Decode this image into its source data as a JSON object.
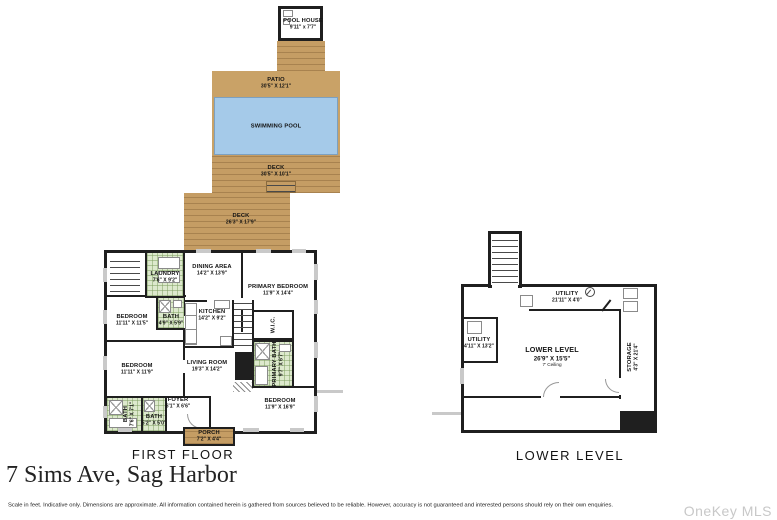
{
  "title": "7 Sims Ave, Sag Harbor",
  "disclaimer": "Scale in feet. Indicative only. Dimensions are approximate. All information contained herein is gathered from sources believed to be reliable. However, accuracy is not guaranteed and interested persons should rely on their own enquiries.",
  "watermark": "OneKey MLS",
  "colors": {
    "deck": "#c59d64",
    "patio": "#c9a267",
    "pool": "#a5cae9",
    "tile": "#dde9cd",
    "wall": "#1f1f1f"
  },
  "first_floor": {
    "caption": "FIRST FLOOR",
    "outdoor": [
      {
        "name": "POOL HOUSE",
        "dims": "9'11\" x 7'7\""
      },
      {
        "name": "PATIO",
        "dims": "30'5\" X 12'1\""
      },
      {
        "name": "SWIMMING POOL",
        "dims": ""
      },
      {
        "name": "DECK",
        "dims": "30'5\" X 10'1\""
      },
      {
        "name": "DECK",
        "dims": "26'3\" X 17'9\""
      },
      {
        "name": "PORCH",
        "dims": "7'2\" X 4'4\""
      }
    ],
    "rooms": [
      {
        "name": "LAUNDRY",
        "dims": "7'6\" X 9'2\""
      },
      {
        "name": "DINING AREA",
        "dims": "14'2\" X 13'9\""
      },
      {
        "name": "PRIMARY BEDROOM",
        "dims": "11'9\" X 14'4\""
      },
      {
        "name": "BATH",
        "dims": "4'9\" X 5'9\""
      },
      {
        "name": "BEDROOM",
        "dims": "11'11\" X 11'5\""
      },
      {
        "name": "KITCHEN",
        "dims": "14'2\" X 9'2\""
      },
      {
        "name": "W.I.C.",
        "dims": ""
      },
      {
        "name": "PRIMARY BATH",
        "dims": "9'7\" X 6'7\""
      },
      {
        "name": "BEDROOM",
        "dims": "11'11\" X 11'9\""
      },
      {
        "name": "LIVING ROOM",
        "dims": "19'3\" X 14'2\""
      },
      {
        "name": "BATH",
        "dims": "7'6\" X 7'1\""
      },
      {
        "name": "BATH",
        "dims": "5'2\" X 5'0\""
      },
      {
        "name": "FOYER",
        "dims": "6'1\" X 6'6\""
      },
      {
        "name": "BEDROOM",
        "dims": "11'9\" X 16'9\""
      }
    ]
  },
  "lower_level": {
    "caption": "LOWER LEVEL",
    "rooms": [
      {
        "name": "UTILITY",
        "dims": "21'11\" X 4'0\""
      },
      {
        "name": "UTILITY",
        "dims": "4'11\" X 13'2\""
      },
      {
        "name": "LOWER LEVEL",
        "dims": "26'9\" X 15'5\"",
        "note": "7' Ceiling"
      },
      {
        "name": "STORAGE",
        "dims": "4'3\" X 21'4\""
      }
    ]
  }
}
